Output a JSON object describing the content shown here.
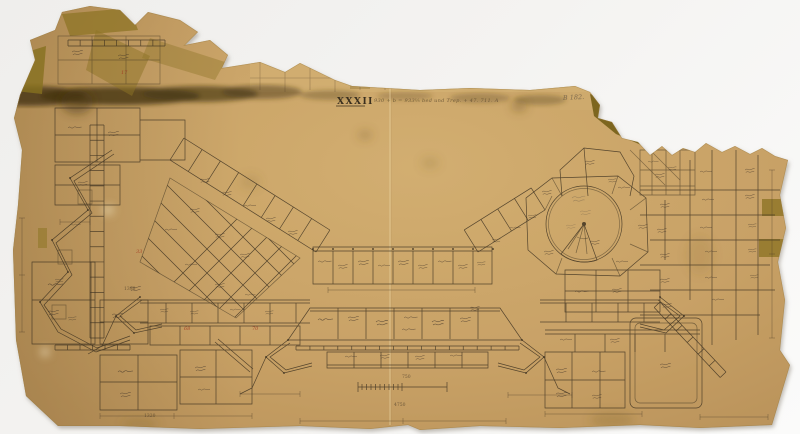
{
  "title": {
    "numeral": "XXXII",
    "annotation": "930 + b = 933⅓ bed und Trep. + 47. 711. A"
  },
  "corner_note": "B 182.",
  "red_marks": [
    "68",
    "70",
    "33",
    "17"
  ],
  "dimension_labels": [
    "1398",
    "750",
    "4750",
    "1320"
  ],
  "colors": {
    "paper": "#c8a166",
    "paper_light": "#d7b577",
    "ink": "#3b3020",
    "red": "#a33a22",
    "tape": "#8d7425",
    "stain": "#3f2f12",
    "pencil": "#6f5f49",
    "background": "#f2f1ee"
  }
}
